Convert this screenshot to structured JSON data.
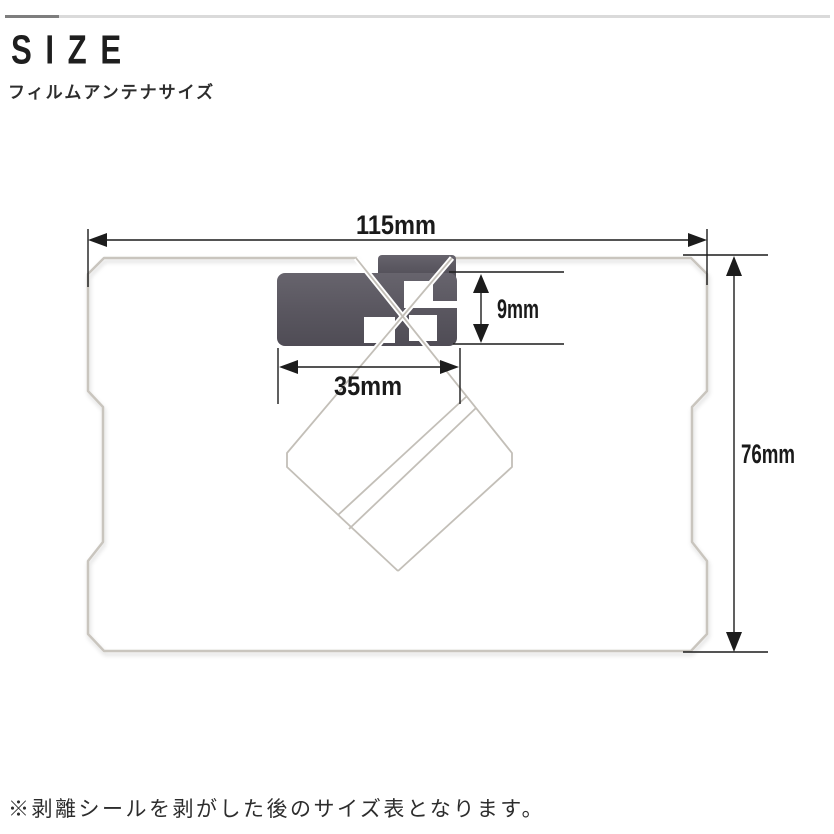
{
  "header": {
    "title": "SIZE",
    "subtitle": "フィルムアンテナサイズ",
    "accent_bar": {
      "dark_color": "#7e7e7e",
      "light_color": "#dadada"
    }
  },
  "diagram": {
    "type": "film-antenna-size-diagram",
    "dimensions": {
      "film_width": "115mm",
      "feed_height": "9mm",
      "feed_width": "35mm",
      "film_height": "76mm"
    },
    "colors": {
      "dimension_line": "#1c1c1c",
      "film_outline": "#c9c5be",
      "antenna_trace": "#c3bfb8",
      "feed_element_dark": "#4f4c55",
      "feed_element_light": "#67646d"
    }
  },
  "footnote": {
    "text": "※剥離シールを剥がした後のサイズ表となります。"
  }
}
